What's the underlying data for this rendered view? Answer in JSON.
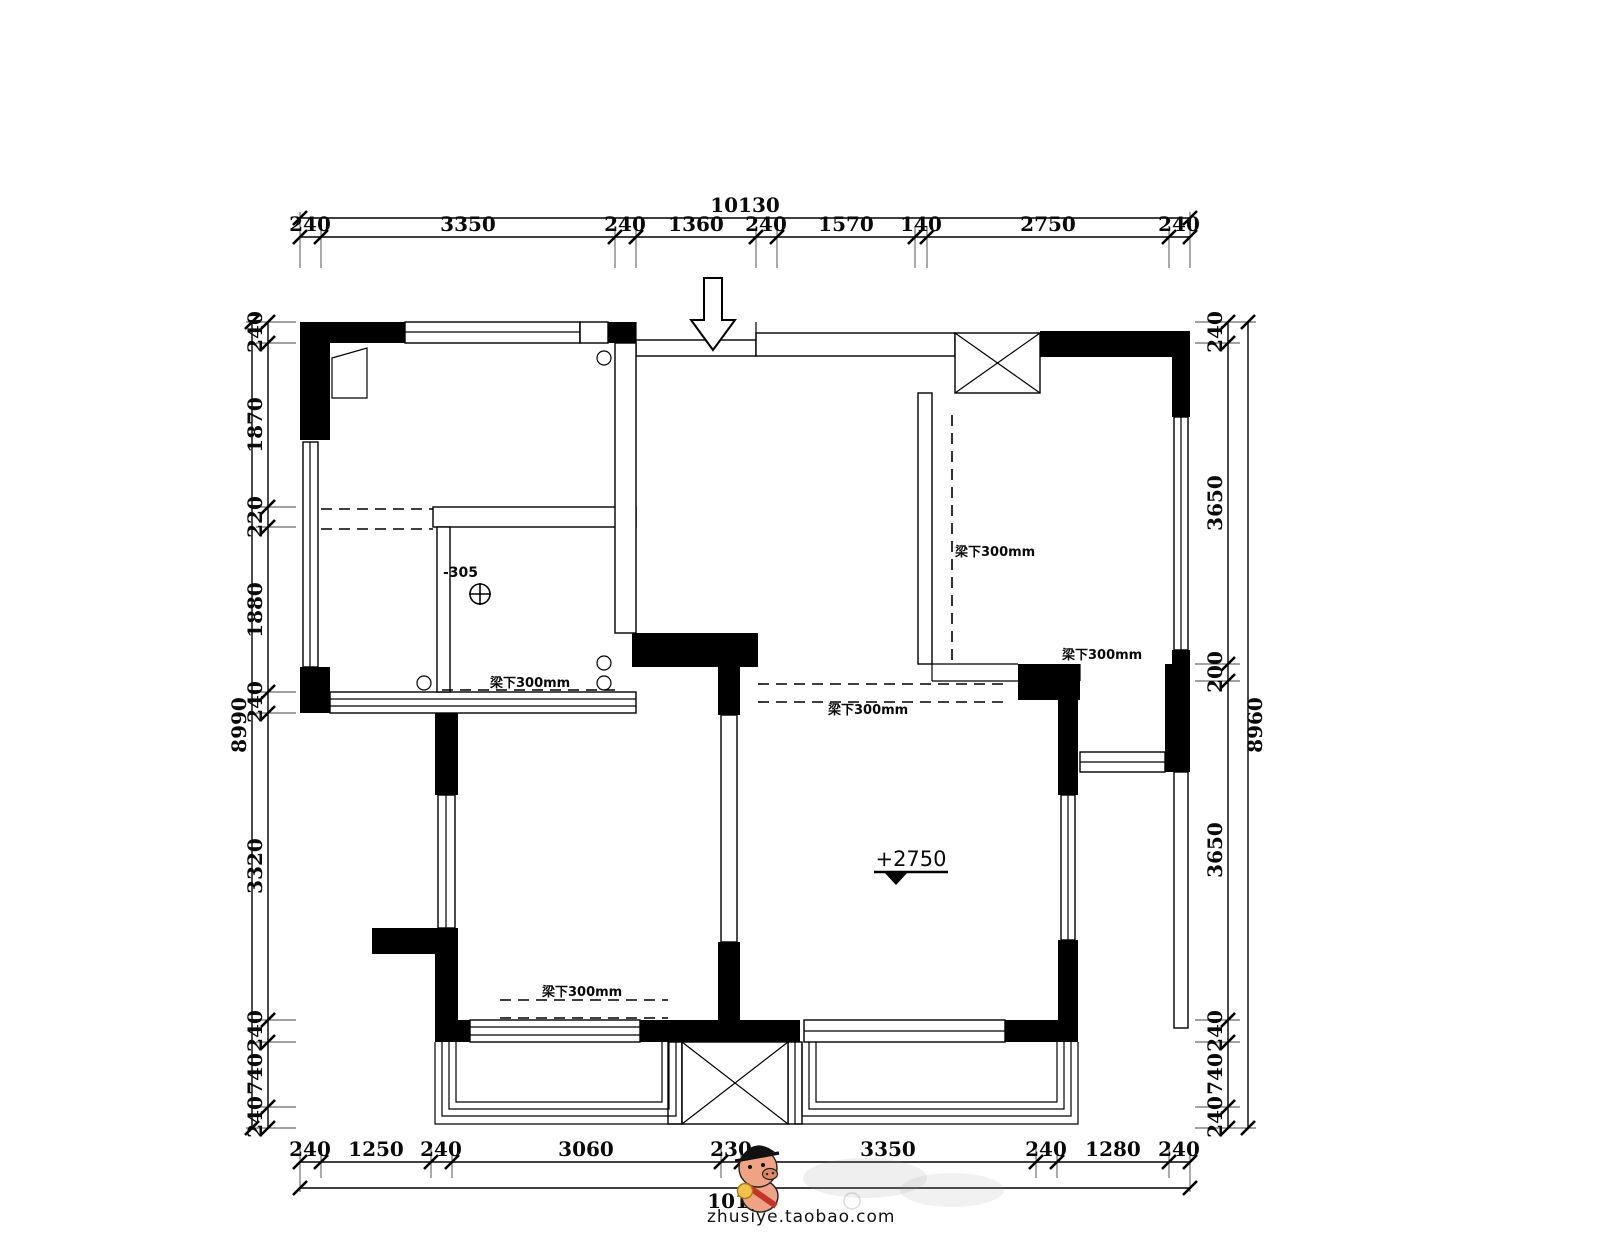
{
  "dims": {
    "top": {
      "total": "10130",
      "segments": [
        "240",
        "3350",
        "240",
        "1360",
        "240",
        "1570",
        "140",
        "2750",
        "240"
      ]
    },
    "bottom": {
      "total": "10130",
      "segments": [
        "240",
        "1250",
        "240",
        "3060",
        "230",
        "3350",
        "240",
        "1280",
        "240"
      ]
    },
    "left": {
      "total": "8990",
      "segments": [
        "240",
        "1870",
        "220",
        "1880",
        "240",
        "3320",
        "240",
        "740",
        "240"
      ]
    },
    "right": {
      "total": "8960",
      "segments": [
        "240",
        "3650",
        "200",
        "3650",
        "240",
        "740",
        "240"
      ]
    }
  },
  "labels": {
    "beam_kitchen_left": "梁下300mm",
    "beam_kitchen_bottom": "梁下300mm",
    "beam_hall": "梁下300mm",
    "beam_left_room": "梁下300mm",
    "beam_bedroom": "梁下300mm",
    "level_mark": "+2750",
    "floor_drop": "-305"
  },
  "watermark": {
    "text": "zhusiye.taobao.com"
  },
  "colors": {
    "ink": "#000000",
    "bg": "#ffffff",
    "mascot_skin": "#f0a384",
    "mascot_snout": "#dd8a66",
    "mascot_sash": "#c2352b",
    "mascot_medal": "#f0c24a"
  }
}
